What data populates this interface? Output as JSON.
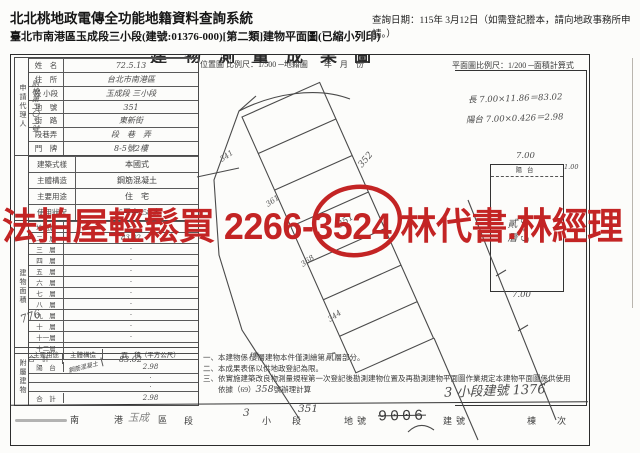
{
  "header": {
    "system_title": "北北桃地政電傳全功能地籍資料查詢系統",
    "query_date": "查詢日期：115年 3月12日（如需登記謄本，請向地政事務所申請。）",
    "subtitle": "臺北市南港區玉成段三小段(建號:01376-000)[第二類]建物平面圖(已縮小列印)"
  },
  "watermark": {
    "text": "法拍屋輕鬆買 2266-3524 林代書.林經理",
    "color": "#c32424"
  },
  "doc": {
    "clipped_title": "建物測量成果圖",
    "scale_location": "位置圖 比例尺：1/500 ─地籍圖　　年　月　份",
    "scale_plan": "平面圖比例尺：1/200 ─面積計算式",
    "form": {
      "side_label": "申請代理人",
      "case_note": "附檢第二〇二號",
      "rows_top": [
        {
          "l": "姓　名",
          "v": "72.5.13"
        },
        {
          "l": "住　所",
          "v": "台北市南港區"
        },
        {
          "l": "段 小段",
          "v": "玉成段 三小段"
        },
        {
          "l": "地　號",
          "v": "351"
        },
        {
          "l": "街　路",
          "v": "東新街"
        },
        {
          "l": "段巷弄",
          "v": "段　巷　弄"
        },
        {
          "l": "門　牌",
          "v": "8-5號2樓"
        }
      ],
      "rows_bottom": [
        {
          "l": "建築式樣",
          "v": "本國式"
        },
        {
          "l": "主體構造",
          "v": "鋼筋混凝土"
        },
        {
          "l": "主要用途",
          "v": "住　宅"
        },
        {
          "l": "使用狀況",
          "v": "65平字258號"
        }
      ]
    },
    "area": {
      "side_label": "建物面積",
      "floors": [
        {
          "f": "地面層",
          "v": "·"
        },
        {
          "f": "二　層",
          "v": "83.02"
        },
        {
          "f": "三　層",
          "v": "·"
        },
        {
          "f": "四　層",
          "v": "·"
        },
        {
          "f": "五　層",
          "v": "·"
        },
        {
          "f": "六　層",
          "v": "·"
        },
        {
          "f": "七　層",
          "v": "·"
        },
        {
          "f": "八　層",
          "v": "·"
        },
        {
          "f": "九　層",
          "v": "·"
        },
        {
          "f": "十　層",
          "v": "·"
        },
        {
          "f": "十一層",
          "v": "·"
        },
        {
          "f": "十二層",
          "v": "·"
        }
      ],
      "total_label": "合　計",
      "total_value": "83.02",
      "hand_note": "776"
    },
    "attached": {
      "side_label": "附屬建物",
      "col1": "主要用途",
      "col2": "主體構造",
      "col3": "面　積（平方公尺）",
      "row_use": "陽　台",
      "row_material": "鋼筋混凝土",
      "row_area": "2.98",
      "dot": "·",
      "total_label": "合　計",
      "total_value": "2.98"
    },
    "calc": {
      "line1": "長 7.00×11.86＝83.02",
      "line2": "陽台 7.00×0.426＝2.98"
    },
    "plan": {
      "dim_top": "7.00",
      "balcony": "陽台",
      "balcony_depth": "1.00",
      "unit_no": "8-5",
      "floor": "貳層",
      "dim_bottom": "7.00"
    },
    "diagram_labels": {
      "left1": "341",
      "left2": "361",
      "left3": "368",
      "bottom": "344",
      "right": "352",
      "circled": "351"
    },
    "notes": {
      "n1a": "一、本建物係",
      "n1h1": "樓",
      "n1b": "層建物本件僅測繪第",
      "n1h2": "貳",
      "n1c": "層部分。",
      "n2": "二、本成果表係以供地政登記為限。",
      "n3": "三、依實施建築改良物測量規程第一次登記後勘測建物位置及再勘測建物平面圖作業規定本建物平面圖係供使用",
      "n4a": "　　依據（69）",
      "n4h": "358",
      "n4b": "號辦理計算",
      "hand_right": "3 小段建號 1376"
    },
    "bottom": {
      "district": "南　港　區",
      "hand_area": "玉成",
      "sec": "段",
      "hand_sec": "3",
      "subsec": "小　段",
      "hand_lot": "351",
      "lot": "地號",
      "bldg_no": "9006",
      "bldg": "建號",
      "unit": "棟　次"
    }
  }
}
